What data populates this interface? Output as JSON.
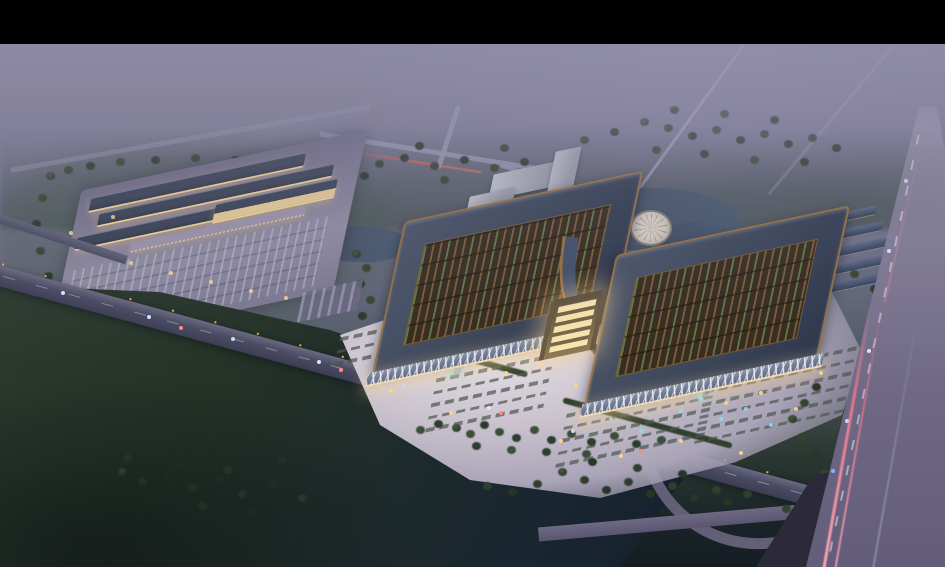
{
  "meta": {
    "type": "architectural-rendering",
    "view": "aerial-dusk",
    "subject": "Illuminated market complex with twin halls, forecourt plaza, retail cluster, roads and tree belts at dusk"
  },
  "palette": {
    "frame": "#000000",
    "haze_top": "#8e8ba8",
    "haze_mid": "#7b7894",
    "treeline_far": "#515e66",
    "field": "#243128",
    "field_dark": "#131c21",
    "tree": "#3c4e3e",
    "road": "#45475c",
    "highway": "#6a6580",
    "trail_red": "#e8707e",
    "trail_orange": "#f09848",
    "plaza": "#c8c1cc",
    "plaza_bright": "#e6e0e8",
    "roof_slate": "#3d4759",
    "copper": "#95703f",
    "court_brown": "#4a3826",
    "lattice_green": "#5a7546",
    "glow": "#f4d694",
    "glow_bright": "#ffedbd",
    "pond": "#42536b",
    "fountain": "#8fd8f0",
    "disc": "#cdc4ba",
    "row_roof": "#4b586e",
    "office": "#b7b9c1"
  },
  "labels": {
    "viewport": "aerial dusk rendering of market complex",
    "top_letterbox": "black letterbox bar",
    "sky_haze": "distant purple haze",
    "far_treeline": "distant tree line",
    "farm_field": "dark farmland",
    "main_road": "front boulevard with street lights and traffic",
    "highway": "expressway with head/tail light trails",
    "left_complex": "illuminated retail complex with parking lot",
    "main_halls": "twin market halls with copper-edged roofs and open lattice courtyards",
    "entrance_gate": "glowing central entrance gate",
    "front_plaza": "bright forecourt plaza",
    "fountains": "lit fountain pools",
    "parking_rows": "parking stall rows",
    "circular_plaza": "circular fountain plaza",
    "row_buildings": "rows of long outbuildings",
    "office_building": "office building",
    "pond": "landscaped pond",
    "tree_belt": "roadside tree belt"
  }
}
